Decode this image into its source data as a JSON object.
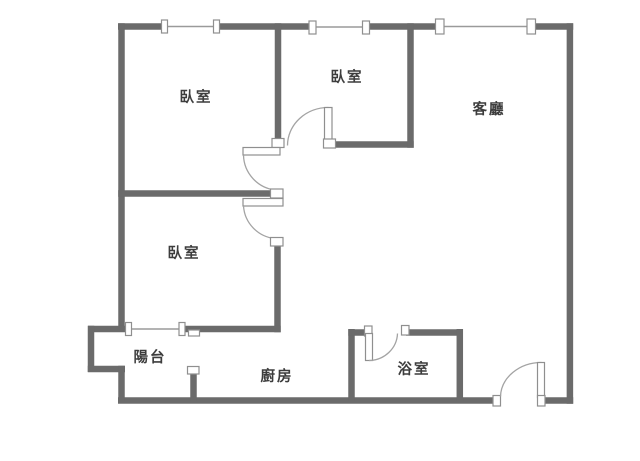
{
  "plan_title": "apartment-floor-plan",
  "colors": {
    "wall": "#6b6b6b",
    "window_line": "#9a9a9a",
    "door_arc": "#a3a3a3",
    "fixture_border": "#8f8f8f",
    "label": "#3d3d3d",
    "background": "#ffffff"
  },
  "rooms": {
    "bedroom_top_left": {
      "label": "臥室"
    },
    "bedroom_top_middle": {
      "label": "臥室"
    },
    "bedroom_bottom_left": {
      "label": "臥室"
    },
    "living_room": {
      "label": "客廳"
    },
    "balcony": {
      "label": "陽台"
    },
    "kitchen": {
      "label": "廚房"
    },
    "bathroom": {
      "label": "浴室"
    }
  }
}
